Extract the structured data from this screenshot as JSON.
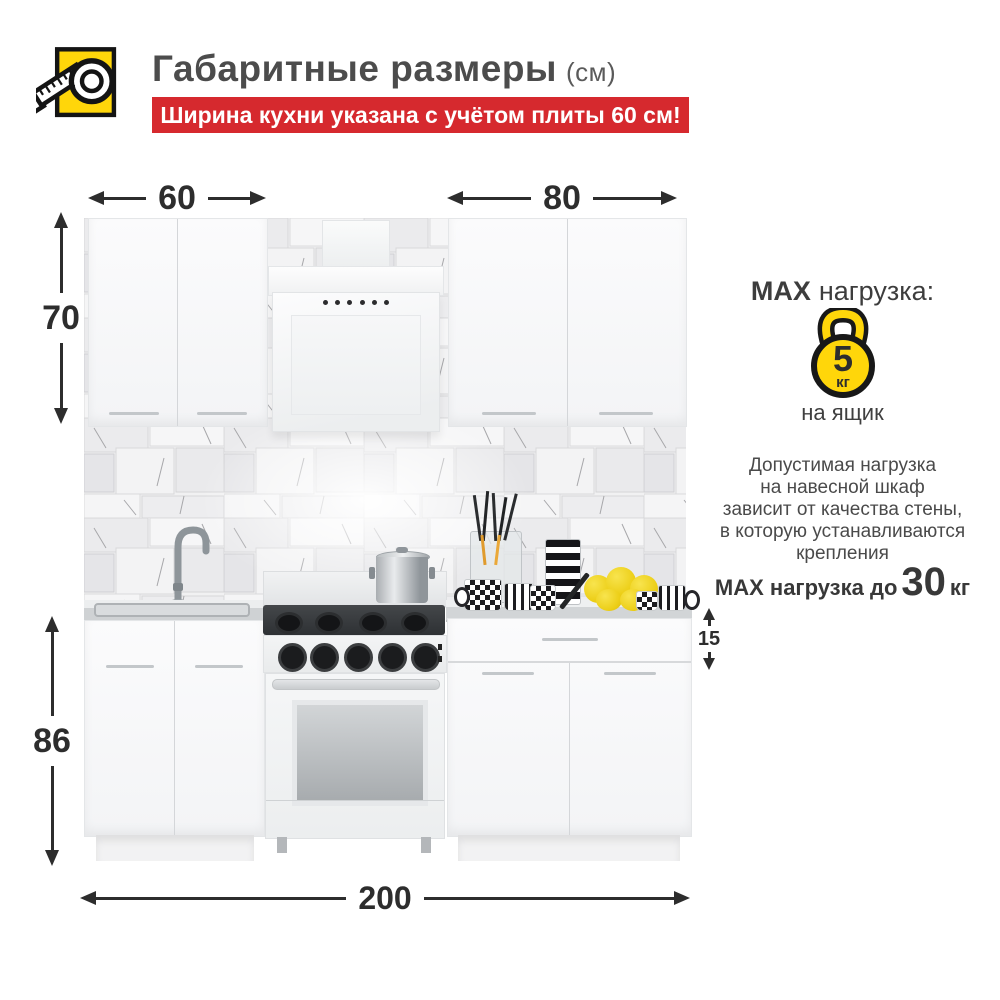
{
  "header": {
    "title": "Габаритные размеры",
    "unit": "(см)",
    "banner": "Ширина кухни указана с учётом плиты 60 см!"
  },
  "dimensions": {
    "upper_left_width": "60",
    "upper_right_width": "80",
    "upper_height": "70",
    "lower_height": "86",
    "drawer_height": "15",
    "total_width": "200"
  },
  "max_load": {
    "title_bold": "MAX",
    "title_rest": "нагрузка:",
    "weight_value": "5",
    "weight_unit": "кг",
    "per_item": "на ящик",
    "note_lines": [
      "Допустимая нагрузка",
      "на навесной шкаф",
      "зависит от качества стены,",
      "в которую устанавливаются",
      "крепления"
    ],
    "bottom_prefix": "MAX нагрузка до",
    "bottom_value": "30",
    "bottom_unit": "кг"
  },
  "colors": {
    "accent_red": "#d6292e",
    "accent_yellow": "#ffd60a",
    "dimension_text": "#2d2d2d",
    "body_text": "#4a4a4a"
  }
}
